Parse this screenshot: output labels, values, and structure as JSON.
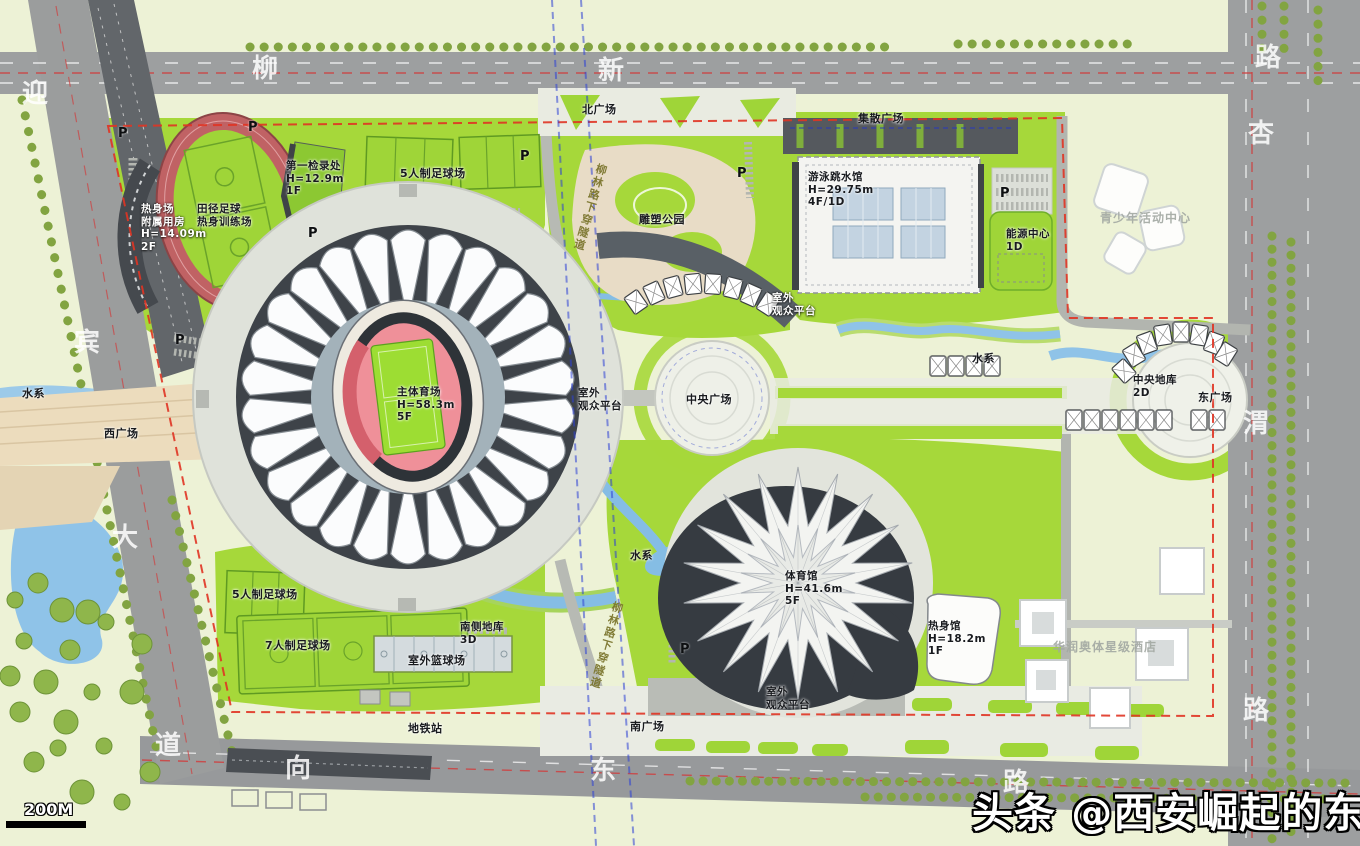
{
  "watermark": {
    "text": "头条 @西安崛起的东城"
  },
  "scale": {
    "label": "200M"
  },
  "parking_label": "P",
  "tunnel_label": "柳林路下穿隧道",
  "roads": {
    "west": {
      "chars": [
        "迎",
        "宾",
        "大",
        "道"
      ]
    },
    "north": {
      "chars": [
        "柳",
        "新",
        "路"
      ]
    },
    "east": {
      "chars": [
        "杏",
        "渭",
        "路"
      ]
    },
    "south": {
      "chars": [
        "向",
        "东",
        "路"
      ]
    }
  },
  "labels": {
    "north_plaza": "北广场",
    "gathering_plaza": "集散广场",
    "natatorium": "游泳跳水馆\nH=29.75m\n4F/1D",
    "energy_center": "能源中心\n1D",
    "youth_center": "青少年活动中心",
    "first_checkin": "第一检录处\nH=12.9m\n1F",
    "futsal_north": "5人制足球场",
    "warmup_annex": "热身场\n附属用房\nH=14.09m\n2F",
    "training_field": "田径足球\n热身训练场",
    "sculpture_park": "雕塑公园",
    "platform_ne": "室外\n观众平台",
    "water_east": "水系",
    "central_garage": "中央地库\n2D",
    "east_plaza": "东广场",
    "central_plaza": "中央广场",
    "platform_west": "室外\n观众平台",
    "main_stadium": "主体育场\nH=58.3m\n5F",
    "west_plaza": "西广场",
    "water_west": "水系",
    "water_south": "水系",
    "gymnasium": "体育馆\nH=41.6m\n5F",
    "warmup_gym": "热身馆\nH=18.2m\n1F",
    "futsal_south": "5人制足球场",
    "football7": "7人制足球场",
    "south_garage": "南侧地库\n3D",
    "basketball": "室外篮球场",
    "metro_station": "地铁站",
    "south_plaza": "南广场",
    "platform_south": "室外\n观众平台",
    "hotel": "华润奥体星级酒店"
  },
  "colors": {
    "lawn_green": "#a6d83a",
    "bright_pitch": "#9fd538",
    "road_gray": "#9d9fa0",
    "water_blue": "#8fc3e8",
    "track_red": "#ef9099",
    "boundary_red": "#e03424",
    "metro_blue": "#2b3fd6",
    "plaza_tan": "#ecdcbd",
    "shadow_dark": "#3a3f45"
  }
}
